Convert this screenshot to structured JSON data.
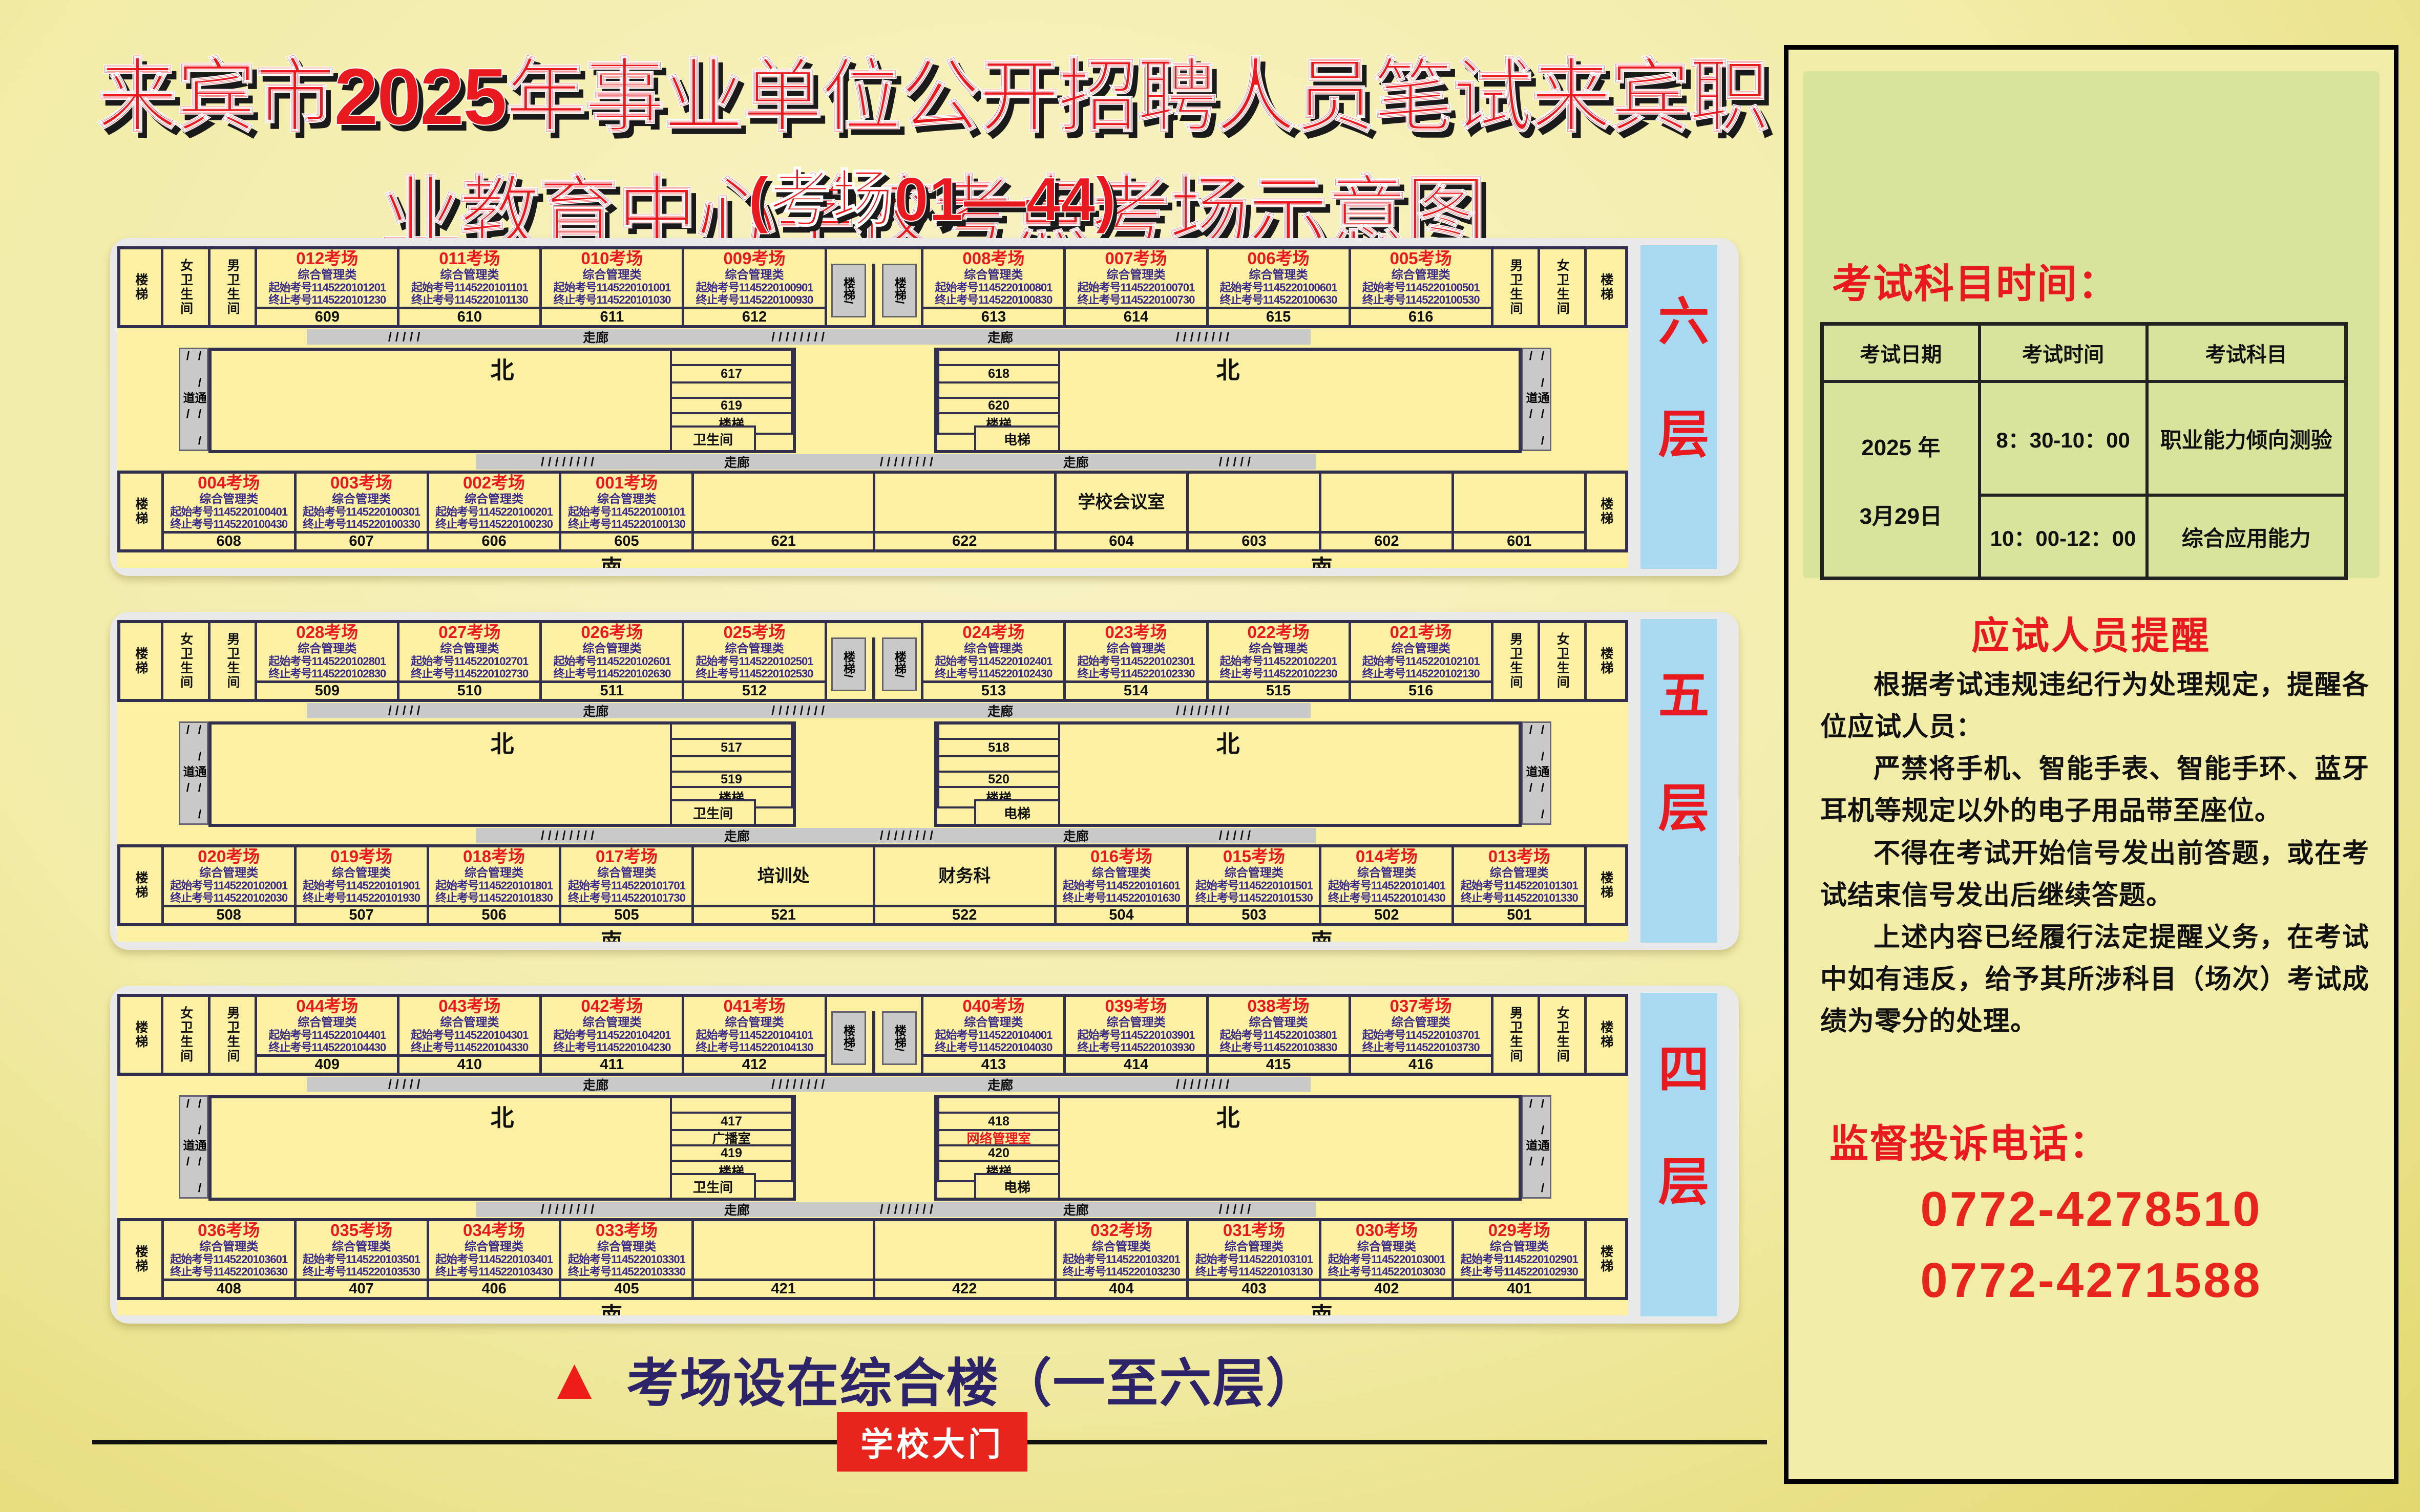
{
  "page": {
    "title": "来宾市2025年事业单位公开招聘人员笔试来宾职业教育中心学校考点考场示意图",
    "subtitle": "(考场01—44)",
    "footer_note": "考场设在综合楼（一至六层）",
    "gate_label": "学校大门",
    "triangle_icon": "▲"
  },
  "colors": {
    "room_title_red": "#e8191f",
    "id_purple": "#3a2b8a",
    "floor_strip_blue": "#a9d8f1",
    "building_yellow": "#fcf0a2",
    "corridor_gray": "#c9c9c9",
    "footer_navy": "#2c2368",
    "gate_red": "#e8251c"
  },
  "labels": {
    "stair": "楼梯",
    "stair_slash": "楼梯/",
    "female_wc": "女卫生间",
    "male_wc": "男卫生间",
    "wc": "卫生间",
    "elevator": "电梯",
    "corridor": "走廊",
    "hatch_a": "/ / / / /",
    "hatch_b": "/ / / / / / / /",
    "passage": "通道",
    "passage_hatch": "/ / /",
    "north": "北",
    "south": "南"
  },
  "floors": [
    {
      "label": "六层",
      "north_left": [
        {
          "title": "012考场",
          "category": "综合管理类",
          "start": "起始考号1145220101201",
          "end": "终止考号1145220101230",
          "no": "609",
          "v": "exam"
        },
        {
          "title": "011考场",
          "category": "综合管理类",
          "start": "起始考号1145220101101",
          "end": "终止考号1145220101130",
          "no": "610",
          "v": "exam"
        },
        {
          "title": "010考场",
          "category": "综合管理类",
          "start": "起始考号1145220101001",
          "end": "终止考号1145220101030",
          "no": "611",
          "v": "exam"
        },
        {
          "title": "009考场",
          "category": "综合管理类",
          "start": "起始考号1145220100901",
          "end": "终止考号1145220100930",
          "no": "612",
          "v": "exam"
        }
      ],
      "north_right": [
        {
          "title": "008考场",
          "category": "综合管理类",
          "start": "起始考号1145220100801",
          "end": "终止考号1145220100830",
          "no": "613",
          "v": "exam"
        },
        {
          "title": "007考场",
          "category": "综合管理类",
          "start": "起始考号1145220100701",
          "end": "终止考号1145220100730",
          "no": "614",
          "v": "exam"
        },
        {
          "title": "006考场",
          "category": "综合管理类",
          "start": "起始考号1145220100601",
          "end": "终止考号1145220100630",
          "no": "615",
          "v": "exam"
        },
        {
          "title": "005考场",
          "category": "综合管理类",
          "start": "起始考号1145220100501",
          "end": "终止考号1145220100530",
          "no": "616",
          "v": "exam"
        }
      ],
      "core_left": [
        {
          "t": "",
          "v": ""
        },
        {
          "t": "617",
          "v": ""
        },
        {
          "t": "",
          "v": ""
        },
        {
          "t": "619",
          "v": ""
        },
        {
          "t": "楼梯",
          "v": ""
        }
      ],
      "core_left_foot": "卫生间",
      "core_right": [
        {
          "t": "",
          "v": ""
        },
        {
          "t": "618",
          "v": ""
        },
        {
          "t": "",
          "v": ""
        },
        {
          "t": "620",
          "v": ""
        },
        {
          "t": "楼梯",
          "v": ""
        }
      ],
      "core_right_foot": "电梯",
      "south_left": [
        {
          "title": "004考场",
          "category": "综合管理类",
          "start": "起始考号1145220100401",
          "end": "终止考号1145220100430",
          "no": "608",
          "v": "exam"
        },
        {
          "title": "003考场",
          "category": "综合管理类",
          "start": "起始考号1145220100301",
          "end": "终止考号1145220100330",
          "no": "607",
          "v": "exam"
        },
        {
          "title": "002考场",
          "category": "综合管理类",
          "start": "起始考号1145220100201",
          "end": "终止考号1145220100230",
          "no": "606",
          "v": "exam"
        },
        {
          "title": "001考场",
          "category": "综合管理类",
          "start": "起始考号1145220100101",
          "end": "终止考号1145220100130",
          "no": "605",
          "v": "exam"
        }
      ],
      "south_left_wide": {
        "title": "",
        "category": "",
        "start": "",
        "end": "",
        "no": "621",
        "v": "plain"
      },
      "south_right_wide": {
        "title": "",
        "category": "",
        "start": "",
        "end": "",
        "no": "622",
        "v": "plain"
      },
      "south_right": [
        {
          "title": "学校会议室",
          "category": "",
          "start": "",
          "end": "",
          "no": "604",
          "v": "plain"
        },
        {
          "title": "",
          "category": "",
          "start": "",
          "end": "",
          "no": "603",
          "v": "plain"
        },
        {
          "title": "",
          "category": "",
          "start": "",
          "end": "",
          "no": "602",
          "v": "plain"
        },
        {
          "title": "",
          "category": "",
          "start": "",
          "end": "",
          "no": "601",
          "v": "plain"
        }
      ]
    },
    {
      "label": "五层",
      "north_left": [
        {
          "title": "028考场",
          "category": "综合管理类",
          "start": "起始考号1145220102801",
          "end": "终止考号1145220102830",
          "no": "509",
          "v": "exam"
        },
        {
          "title": "027考场",
          "category": "综合管理类",
          "start": "起始考号1145220102701",
          "end": "终止考号1145220102730",
          "no": "510",
          "v": "exam"
        },
        {
          "title": "026考场",
          "category": "综合管理类",
          "start": "起始考号1145220102601",
          "end": "终止考号1145220102630",
          "no": "511",
          "v": "exam"
        },
        {
          "title": "025考场",
          "category": "综合管理类",
          "start": "起始考号1145220102501",
          "end": "终止考号1145220102530",
          "no": "512",
          "v": "exam"
        }
      ],
      "north_right": [
        {
          "title": "024考场",
          "category": "综合管理类",
          "start": "起始考号1145220102401",
          "end": "终止考号1145220102430",
          "no": "513",
          "v": "exam"
        },
        {
          "title": "023考场",
          "category": "综合管理类",
          "start": "起始考号1145220102301",
          "end": "终止考号1145220102330",
          "no": "514",
          "v": "exam"
        },
        {
          "title": "022考场",
          "category": "综合管理类",
          "start": "起始考号1145220102201",
          "end": "终止考号1145220102230",
          "no": "515",
          "v": "exam"
        },
        {
          "title": "021考场",
          "category": "综合管理类",
          "start": "起始考号1145220102101",
          "end": "终止考号1145220102130",
          "no": "516",
          "v": "exam"
        }
      ],
      "core_left": [
        {
          "t": "",
          "v": ""
        },
        {
          "t": "517",
          "v": ""
        },
        {
          "t": "",
          "v": ""
        },
        {
          "t": "519",
          "v": ""
        },
        {
          "t": "楼梯",
          "v": ""
        }
      ],
      "core_left_foot": "卫生间",
      "core_right": [
        {
          "t": "",
          "v": ""
        },
        {
          "t": "518",
          "v": ""
        },
        {
          "t": "",
          "v": ""
        },
        {
          "t": "520",
          "v": ""
        },
        {
          "t": "楼梯",
          "v": ""
        }
      ],
      "core_right_foot": "电梯",
      "south_left": [
        {
          "title": "020考场",
          "category": "综合管理类",
          "start": "起始考号1145220102001",
          "end": "终止考号1145220102030",
          "no": "508",
          "v": "exam"
        },
        {
          "title": "019考场",
          "category": "综合管理类",
          "start": "起始考号1145220101901",
          "end": "终止考号1145220101930",
          "no": "507",
          "v": "exam"
        },
        {
          "title": "018考场",
          "category": "综合管理类",
          "start": "起始考号1145220101801",
          "end": "终止考号1145220101830",
          "no": "506",
          "v": "exam"
        },
        {
          "title": "017考场",
          "category": "综合管理类",
          "start": "起始考号1145220101701",
          "end": "终止考号1145220101730",
          "no": "505",
          "v": "exam"
        }
      ],
      "south_left_wide": {
        "title": "培训处",
        "category": "",
        "start": "",
        "end": "",
        "no": "521",
        "v": "plain"
      },
      "south_right_wide": {
        "title": "财务科",
        "category": "",
        "start": "",
        "end": "",
        "no": "522",
        "v": "plain"
      },
      "south_right": [
        {
          "title": "016考场",
          "category": "综合管理类",
          "start": "起始考号1145220101601",
          "end": "终止考号1145220101630",
          "no": "504",
          "v": "exam"
        },
        {
          "title": "015考场",
          "category": "综合管理类",
          "start": "起始考号1145220101501",
          "end": "终止考号1145220101530",
          "no": "503",
          "v": "exam"
        },
        {
          "title": "014考场",
          "category": "综合管理类",
          "start": "起始考号1145220101401",
          "end": "终止考号1145220101430",
          "no": "502",
          "v": "exam"
        },
        {
          "title": "013考场",
          "category": "综合管理类",
          "start": "起始考号1145220101301",
          "end": "终止考号1145220101330",
          "no": "501",
          "v": "exam"
        }
      ]
    },
    {
      "label": "四层",
      "north_left": [
        {
          "title": "044考场",
          "category": "综合管理类",
          "start": "起始考号1145220104401",
          "end": "终止考号1145220104430",
          "no": "409",
          "v": "exam"
        },
        {
          "title": "043考场",
          "category": "综合管理类",
          "start": "起始考号1145220104301",
          "end": "终止考号1145220104330",
          "no": "410",
          "v": "exam"
        },
        {
          "title": "042考场",
          "category": "综合管理类",
          "start": "起始考号1145220104201",
          "end": "终止考号1145220104230",
          "no": "411",
          "v": "exam"
        },
        {
          "title": "041考场",
          "category": "综合管理类",
          "start": "起始考号1145220104101",
          "end": "终止考号1145220104130",
          "no": "412",
          "v": "exam"
        }
      ],
      "north_right": [
        {
          "title": "040考场",
          "category": "综合管理类",
          "start": "起始考号1145220104001",
          "end": "终止考号1145220104030",
          "no": "413",
          "v": "exam"
        },
        {
          "title": "039考场",
          "category": "综合管理类",
          "start": "起始考号1145220103901",
          "end": "终止考号1145220103930",
          "no": "414",
          "v": "exam"
        },
        {
          "title": "038考场",
          "category": "综合管理类",
          "start": "起始考号1145220103801",
          "end": "终止考号1145220103830",
          "no": "415",
          "v": "exam"
        },
        {
          "title": "037考场",
          "category": "综合管理类",
          "start": "起始考号1145220103701",
          "end": "终止考号1145220103730",
          "no": "416",
          "v": "exam"
        }
      ],
      "core_left": [
        {
          "t": "",
          "v": ""
        },
        {
          "t": "417",
          "v": ""
        },
        {
          "t": "广播室",
          "v": ""
        },
        {
          "t": "419",
          "v": ""
        },
        {
          "t": "楼梯",
          "v": ""
        }
      ],
      "core_left_foot": "卫生间",
      "core_right": [
        {
          "t": "",
          "v": ""
        },
        {
          "t": "418",
          "v": ""
        },
        {
          "t": "网络管理室",
          "v": "red"
        },
        {
          "t": "420",
          "v": ""
        },
        {
          "t": "楼梯",
          "v": ""
        }
      ],
      "core_right_foot": "电梯",
      "south_left": [
        {
          "title": "036考场",
          "category": "综合管理类",
          "start": "起始考号1145220103601",
          "end": "终止考号1145220103630",
          "no": "408",
          "v": "exam"
        },
        {
          "title": "035考场",
          "category": "综合管理类",
          "start": "起始考号1145220103501",
          "end": "终止考号1145220103530",
          "no": "407",
          "v": "exam"
        },
        {
          "title": "034考场",
          "category": "综合管理类",
          "start": "起始考号1145220103401",
          "end": "终止考号1145220103430",
          "no": "406",
          "v": "exam"
        },
        {
          "title": "033考场",
          "category": "综合管理类",
          "start": "起始考号1145220103301",
          "end": "终止考号1145220103330",
          "no": "405",
          "v": "exam"
        }
      ],
      "south_left_wide": {
        "title": "",
        "category": "",
        "start": "",
        "end": "",
        "no": "421",
        "v": "plain"
      },
      "south_right_wide": {
        "title": "",
        "category": "",
        "start": "",
        "end": "",
        "no": "422",
        "v": "plain"
      },
      "south_right": [
        {
          "title": "032考场",
          "category": "综合管理类",
          "start": "起始考号1145220103201",
          "end": "终止考号1145220103230",
          "no": "404",
          "v": "exam"
        },
        {
          "title": "031考场",
          "category": "综合管理类",
          "start": "起始考号1145220103101",
          "end": "终止考号1145220103130",
          "no": "403",
          "v": "exam"
        },
        {
          "title": "030考场",
          "category": "综合管理类",
          "start": "起始考号1145220103001",
          "end": "终止考号1145220103030",
          "no": "402",
          "v": "exam"
        },
        {
          "title": "029考场",
          "category": "综合管理类",
          "start": "起始考号1145220102901",
          "end": "终止考号1145220102930",
          "no": "401",
          "v": "exam"
        }
      ]
    }
  ],
  "schedule": {
    "title": "考试科目时间：",
    "headers": [
      "考试日期",
      "考试时间",
      "考试科目"
    ],
    "date_lines": [
      "2025 年",
      "3月29日"
    ],
    "rows": [
      {
        "time": "8：30-10：00",
        "subject": "职业能力倾向测验"
      },
      {
        "time": "10：00-12：00",
        "subject": "综合应用能力"
      }
    ]
  },
  "reminder": {
    "title": "应试人员提醒",
    "paragraphs": [
      "根据考试违规违纪行为处理规定，提醒各位应试人员：",
      "严禁将手机、智能手表、智能手环、蓝牙耳机等规定以外的电子用品带至座位。",
      "不得在考试开始信号发出前答题，或在考试结束信号发出后继续答题。",
      "上述内容已经履行法定提醒义务，在考试中如有违反，给予其所涉科目（场次）考试成绩为零分的处理。"
    ]
  },
  "complaint": {
    "title": "监督投诉电话：",
    "phones": [
      "0772-4278510",
      "0772-4271588"
    ]
  }
}
